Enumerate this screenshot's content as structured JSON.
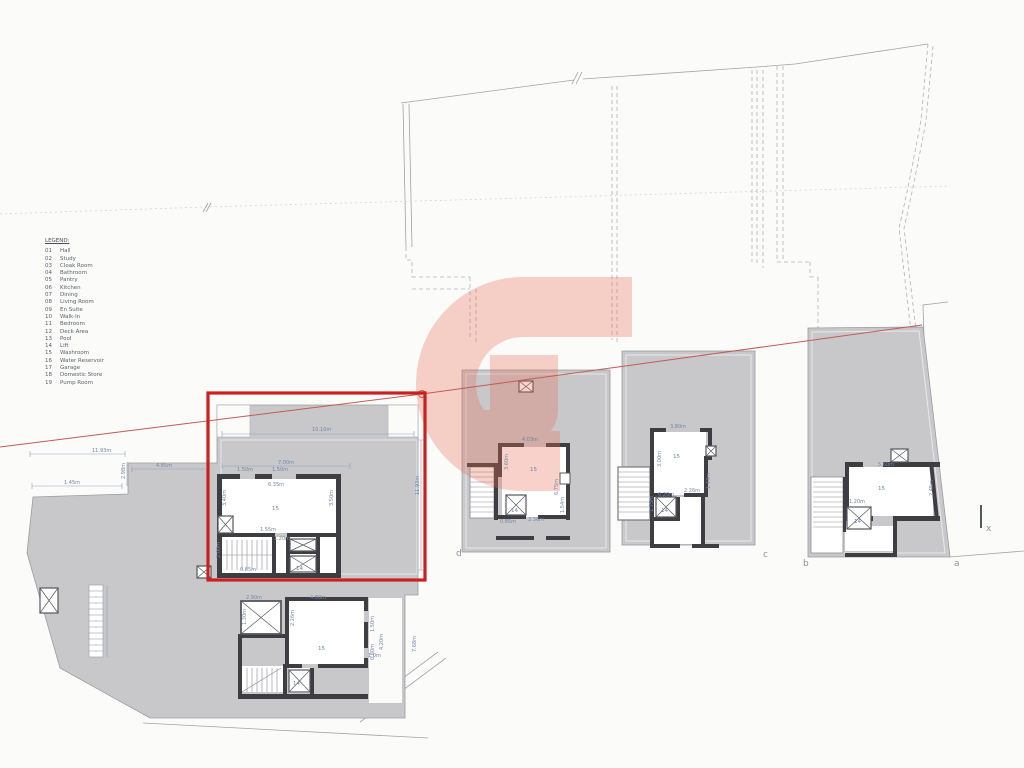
{
  "legend": {
    "title": "LEGEND:",
    "items": [
      {
        "code": "01",
        "label": "Hall"
      },
      {
        "code": "02",
        "label": "Study"
      },
      {
        "code": "03",
        "label": "Cloak Room"
      },
      {
        "code": "04",
        "label": "Bathroom"
      },
      {
        "code": "05",
        "label": "Pantry"
      },
      {
        "code": "06",
        "label": "Kitchen"
      },
      {
        "code": "07",
        "label": "Dining"
      },
      {
        "code": "08",
        "label": "Living Room"
      },
      {
        "code": "09",
        "label": "En Suite"
      },
      {
        "code": "10",
        "label": "Walk-In"
      },
      {
        "code": "11",
        "label": "Bedroom"
      },
      {
        "code": "12",
        "label": "Deck Area"
      },
      {
        "code": "13",
        "label": "Pool"
      },
      {
        "code": "14",
        "label": "Lift"
      },
      {
        "code": "15",
        "label": "Washroom"
      },
      {
        "code": "16",
        "label": "Water Reservoir"
      },
      {
        "code": "17",
        "label": "Garage"
      },
      {
        "code": "18",
        "label": "Domestic Store"
      },
      {
        "code": "19",
        "label": "Pump Room"
      }
    ]
  },
  "colors": {
    "highlight": "#cc1f1f",
    "watermark": "#e86a52",
    "terrace": "#c8c8ca",
    "wall": "#3e3e42",
    "dim_text": "#7087a6"
  },
  "plot_labels": {
    "a": "a",
    "b": "b",
    "c": "c",
    "d": "d",
    "x": "x"
  },
  "units": {
    "u1": {
      "room": "15",
      "lift": "14",
      "dims": {
        "w": "10.10m",
        "inner_w": "7.00m",
        "d1": "1.50m",
        "d2": "1.50m",
        "room_w": "6.35m",
        "room_l": "3.40m",
        "room_r": "3.50m",
        "b1": "1.55m",
        "b2": "1.20m",
        "stair": "2.00m",
        "s2": "0.85m",
        "h": "11.93m"
      }
    },
    "terrace": {
      "dims": {
        "w": "11.93m",
        "d1": "4.85m",
        "d2": "2.98m",
        "d3": "1.45m"
      }
    },
    "ub": {
      "room": "15",
      "lift": "14",
      "dims": {
        "sky_w": "2.90m",
        "sky_h": "1.30m",
        "room_w": "4.80m",
        "room_l": "2.26m",
        "r1": "1.50m",
        "r2": "0.80m",
        "r3": "4.20m",
        "r4": "7.68m",
        "r5": "1.0m"
      }
    },
    "ud": {
      "room": "15",
      "lift": "14",
      "dims": {
        "room_w": "4.03m",
        "l": "3.60m",
        "r": "6.75m",
        "b": "2.36m",
        "r2": "1.54m",
        "s": "0.85m"
      }
    },
    "uc": {
      "room": "15",
      "lift": "14",
      "dims": {
        "room_w": "3.80m",
        "l": "3.00m",
        "b": "2.26m",
        "r": "1.44m",
        "s": "1.75m",
        "n": "0.20m"
      }
    },
    "uba": {
      "room": "15",
      "lift": "14",
      "dims": {
        "room_w": "5.60m",
        "r": "2.45m",
        "l": "1.20m"
      }
    }
  }
}
